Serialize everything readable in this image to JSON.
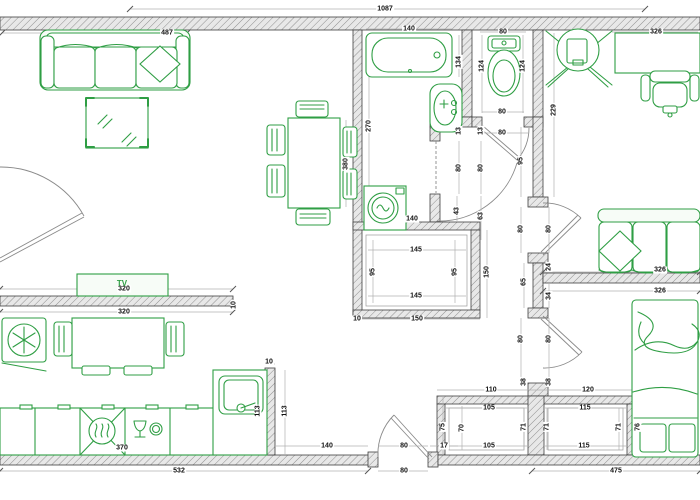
{
  "meta": {
    "drawing_type": "apartment floor plan"
  },
  "colors": {
    "furniture_green": "#2f9e44",
    "wall_stroke": "#3f3f3f",
    "wall_fill": "#e8e8e8",
    "dim_line": "#b0b0b0",
    "dim_text": "#111111",
    "door_line": "#8a8a8a",
    "bg": "#ffffff"
  },
  "furniture_items": [
    "sofa",
    "coffee-table",
    "dining-table-with-6-chairs",
    "bathtub",
    "washbasin",
    "washing-machine",
    "toilet",
    "corner-tv",
    "desk",
    "office-chair",
    "lounge-sofa",
    "double-bed",
    "tv-cabinet",
    "refrigerator",
    "kitchen-table-with-chairs",
    "kitchen-counter",
    "stove",
    "dishwasher",
    "kitchen-sink"
  ],
  "labels": {
    "tv_unit": "TV",
    "dims": [
      {
        "t": "1087",
        "x": 385,
        "y": 9,
        "v": false
      },
      {
        "t": "487",
        "x": 167,
        "y": 33,
        "v": false
      },
      {
        "t": "140",
        "x": 409,
        "y": 29,
        "v": false
      },
      {
        "t": "80",
        "x": 503,
        "y": 32,
        "v": false
      },
      {
        "t": "326",
        "x": 656,
        "y": 32,
        "v": false
      },
      {
        "t": "134",
        "x": 459,
        "y": 62,
        "v": true
      },
      {
        "t": "124",
        "x": 482,
        "y": 66,
        "v": true
      },
      {
        "t": "124",
        "x": 523,
        "y": 66,
        "v": true
      },
      {
        "t": "229",
        "x": 554,
        "y": 110,
        "v": true
      },
      {
        "t": "270",
        "x": 369,
        "y": 126,
        "v": true
      },
      {
        "t": "80",
        "x": 502,
        "y": 112,
        "v": false
      },
      {
        "t": "80",
        "x": 502,
        "y": 133,
        "v": false
      },
      {
        "t": "13",
        "x": 459,
        "y": 131,
        "v": true
      },
      {
        "t": "13",
        "x": 481,
        "y": 131,
        "v": true
      },
      {
        "t": "80",
        "x": 459,
        "y": 168,
        "v": true
      },
      {
        "t": "80",
        "x": 481,
        "y": 168,
        "v": true
      },
      {
        "t": "95",
        "x": 521,
        "y": 161,
        "v": true
      },
      {
        "t": "43",
        "x": 457,
        "y": 211,
        "v": true
      },
      {
        "t": "63",
        "x": 481,
        "y": 216,
        "v": true
      },
      {
        "t": "80",
        "x": 521,
        "y": 229,
        "v": true
      },
      {
        "t": "80",
        "x": 549,
        "y": 229,
        "v": true
      },
      {
        "t": "24",
        "x": 549,
        "y": 267,
        "v": true
      },
      {
        "t": "65",
        "x": 524,
        "y": 282,
        "v": true
      },
      {
        "t": "34",
        "x": 549,
        "y": 296,
        "v": true
      },
      {
        "t": "80",
        "x": 521,
        "y": 339,
        "v": true
      },
      {
        "t": "80",
        "x": 549,
        "y": 339,
        "v": true
      },
      {
        "t": "38",
        "x": 524,
        "y": 382,
        "v": true
      },
      {
        "t": "38",
        "x": 549,
        "y": 382,
        "v": true
      },
      {
        "t": "140",
        "x": 412,
        "y": 219,
        "v": false
      },
      {
        "t": "145",
        "x": 416,
        "y": 250,
        "v": false
      },
      {
        "t": "95",
        "x": 373,
        "y": 272,
        "v": true
      },
      {
        "t": "95",
        "x": 455,
        "y": 272,
        "v": true
      },
      {
        "t": "150",
        "x": 487,
        "y": 272,
        "v": true
      },
      {
        "t": "145",
        "x": 416,
        "y": 296,
        "v": false
      },
      {
        "t": "10",
        "x": 357,
        "y": 319,
        "v": false
      },
      {
        "t": "150",
        "x": 417,
        "y": 319,
        "v": false
      },
      {
        "t": "380",
        "x": 346,
        "y": 164,
        "v": true
      },
      {
        "t": "320",
        "x": 124,
        "y": 289,
        "v": false
      },
      {
        "t": "320",
        "x": 124,
        "y": 312,
        "v": false
      },
      {
        "t": "10",
        "x": 234,
        "y": 305,
        "v": true
      },
      {
        "t": "370",
        "x": 122,
        "y": 448,
        "v": false
      },
      {
        "t": "10",
        "x": 269,
        "y": 362,
        "v": false
      },
      {
        "t": "113",
        "x": 258,
        "y": 411,
        "v": true
      },
      {
        "t": "113",
        "x": 285,
        "y": 411,
        "v": true
      },
      {
        "t": "532",
        "x": 179,
        "y": 471,
        "v": false
      },
      {
        "t": "140",
        "x": 327,
        "y": 446,
        "v": false
      },
      {
        "t": "80",
        "x": 404,
        "y": 446,
        "v": false
      },
      {
        "t": "17",
        "x": 444,
        "y": 446,
        "v": false
      },
      {
        "t": "80",
        "x": 404,
        "y": 471,
        "v": false
      },
      {
        "t": "110",
        "x": 491,
        "y": 390,
        "v": false
      },
      {
        "t": "120",
        "x": 588,
        "y": 390,
        "v": false
      },
      {
        "t": "105",
        "x": 489,
        "y": 408,
        "v": false
      },
      {
        "t": "115",
        "x": 585,
        "y": 408,
        "v": false
      },
      {
        "t": "75",
        "x": 443,
        "y": 427,
        "v": true
      },
      {
        "t": "70",
        "x": 462,
        "y": 428,
        "v": true
      },
      {
        "t": "71",
        "x": 524,
        "y": 427,
        "v": true
      },
      {
        "t": "71",
        "x": 547,
        "y": 427,
        "v": true
      },
      {
        "t": "71",
        "x": 619,
        "y": 427,
        "v": true
      },
      {
        "t": "76",
        "x": 638,
        "y": 427,
        "v": true
      },
      {
        "t": "105",
        "x": 489,
        "y": 446,
        "v": false
      },
      {
        "t": "115",
        "x": 584,
        "y": 446,
        "v": false
      },
      {
        "t": "475",
        "x": 616,
        "y": 471,
        "v": false
      },
      {
        "t": "326",
        "x": 660,
        "y": 270,
        "v": false
      },
      {
        "t": "326",
        "x": 660,
        "y": 291,
        "v": false
      }
    ]
  }
}
